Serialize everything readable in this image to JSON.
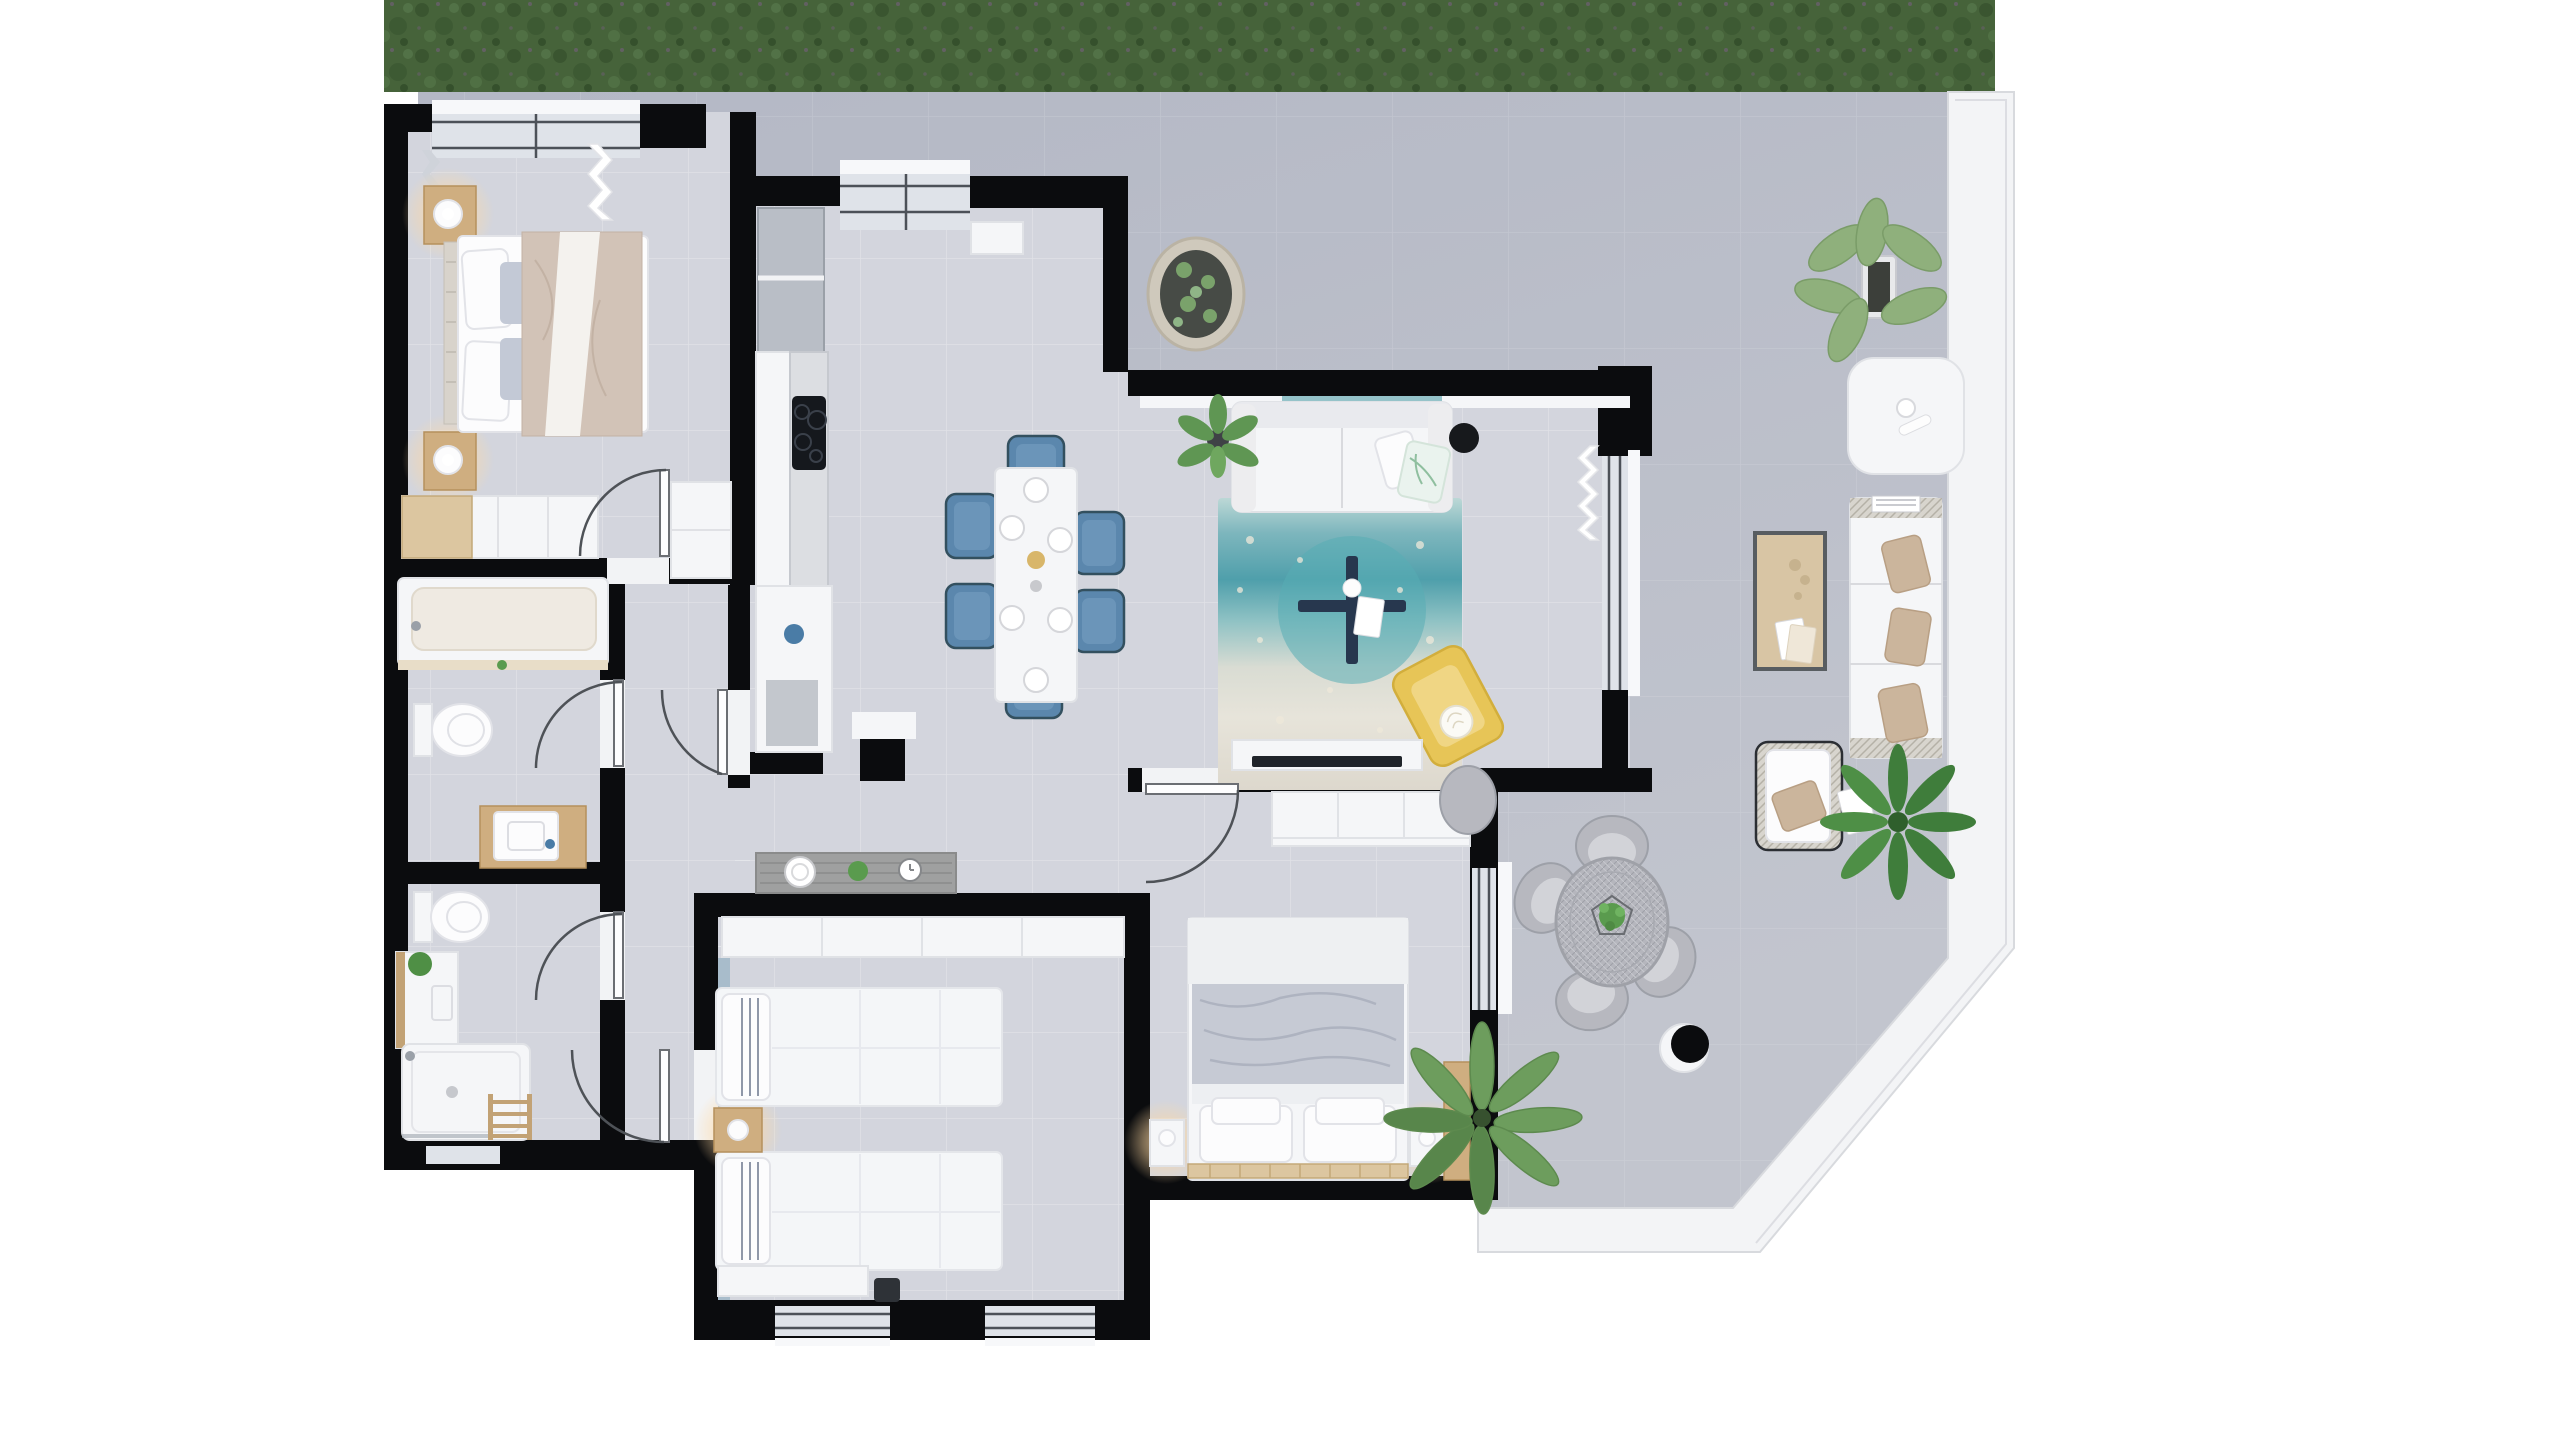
{
  "scene": {
    "type": "architectural-floor-plan-render",
    "view": "top-down",
    "description": "Photorealistic top-down rendering of a furnished apartment with a large wrap-around terrace on the right side, a grass strip along the top edge, and a diagonally cut terrace corner at the bottom right."
  },
  "colors": {
    "page_background": "#ffffff",
    "grass": "#46633a",
    "grass_dark": "#3a5530",
    "terrace_floor": "#b9bdc9",
    "terrace_edge_band": "#f3f4f6",
    "interior_floor": "#d3d5dd",
    "wall": "#0b0c0e",
    "white_furniture": "#f5f6f8",
    "wood": "#cfae80",
    "rug_teal": "#57adb5",
    "rug_base": "#e7e4da",
    "dining_chair_blue": "#5b87ad",
    "armchair_yellow": "#e7c557",
    "outdoor_pillow_beige": "#cbb59c",
    "plant_green": "#6d9d5d",
    "lamp_glow": "#ffd9a2",
    "coffee_table_navy": "#27374e"
  },
  "rooms": [
    {
      "name": "master-bedroom",
      "furniture": [
        "double-bed",
        "headboard",
        "nightstand-with-lamp-top",
        "nightstand-with-lamp-bottom",
        "closet",
        "built-in-wardrobe",
        "window-with-curtain"
      ]
    },
    {
      "name": "kitchen",
      "furniture": [
        "upper-cabinets",
        "counter-with-cooktop",
        "tall-cabinet",
        "shelf-cabinet",
        "window"
      ]
    },
    {
      "name": "dining-area",
      "furniture": [
        "dining-table",
        "six-blue-chairs",
        "place-settings",
        "sideboard-with-decor",
        "structural-column"
      ]
    },
    {
      "name": "living-room",
      "furniture": [
        "sofa-with-pillows",
        "teal-rug",
        "navy-cross-coffee-table",
        "yellow-armchair",
        "tv-console",
        "floor-lamp",
        "potted-plant",
        "sliding-glass-door"
      ]
    },
    {
      "name": "hallway",
      "furniture": [
        "doors-with-swing-arcs"
      ]
    },
    {
      "name": "bathroom-1",
      "furniture": [
        "bathtub",
        "toilet",
        "wood-vanity-with-sink"
      ]
    },
    {
      "name": "bathroom-2",
      "furniture": [
        "toilet",
        "vanity-with-plant",
        "shower",
        "towel-ladder"
      ]
    },
    {
      "name": "twin-bedroom",
      "furniture": [
        "single-bed-1",
        "single-bed-2",
        "nightstand-with-lamp",
        "wardrobe-band",
        "desk",
        "chair",
        "two-bottom-windows"
      ]
    },
    {
      "name": "double-bedroom",
      "furniture": [
        "double-bed-gray-duvet",
        "nightstand-left",
        "nightstand-right",
        "built-in-closet",
        "wardrobe",
        "glass-door-to-terrace"
      ]
    },
    {
      "name": "terrace",
      "furniture": [
        "oval-stone-planter",
        "fan-palm-plant-top",
        "white-side-table",
        "outdoor-sofa",
        "wood-coffee-table",
        "outdoor-armchair",
        "fern-plant",
        "round-wicker-dining-table",
        "wicker-chairs",
        "wicker-pouf",
        "white-cylinder-stool",
        "palm-plant-bottom",
        "grass-strip"
      ]
    }
  ]
}
